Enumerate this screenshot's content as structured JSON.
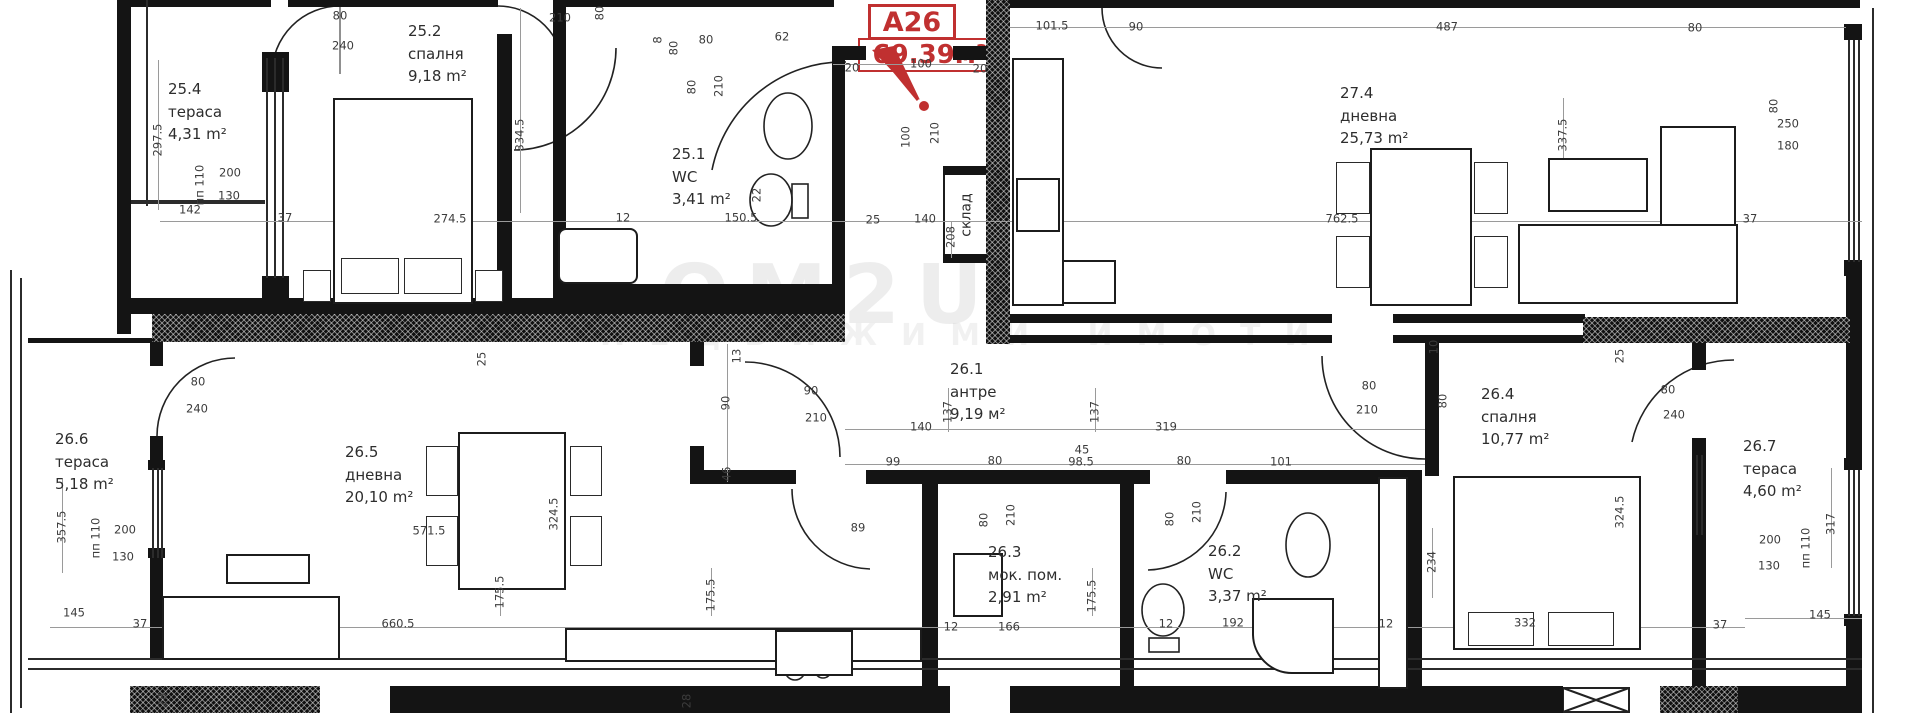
{
  "badge": {
    "unit": "A26",
    "area": "69.39м²"
  },
  "watermark": {
    "line1": "НОМ2U",
    "line2": "НЕДВИЖИМИ ИМОТИ"
  },
  "storage_label": "склад",
  "fridge_label": "F",
  "rooms": [
    {
      "num": "25.4",
      "name": "тераса",
      "area": "4,31 m²",
      "x": 168,
      "y": 78
    },
    {
      "num": "25.2",
      "name": "спалня",
      "area": "9,18 m²",
      "x": 408,
      "y": 20
    },
    {
      "num": "25.1",
      "name": "WC",
      "area": "3,41 m²",
      "x": 672,
      "y": 143
    },
    {
      "num": "27.4",
      "name": "дневна",
      "area": "25,73 m²",
      "x": 1340,
      "y": 82
    },
    {
      "num": "26.1",
      "name": "антре",
      "area": "9,19 м²",
      "x": 950,
      "y": 358
    },
    {
      "num": "26.6",
      "name": "тераса",
      "area": "5,18 m²",
      "x": 55,
      "y": 428
    },
    {
      "num": "26.5",
      "name": "дневна",
      "area": "20,10 m²",
      "x": 345,
      "y": 441
    },
    {
      "num": "26.3",
      "name": "мок. пом.",
      "area": "2,91 m²",
      "x": 988,
      "y": 541
    },
    {
      "num": "26.2",
      "name": "WC",
      "area": "3,37 m²",
      "x": 1208,
      "y": 540
    },
    {
      "num": "26.4",
      "name": "спалня",
      "area": "10,77 m²",
      "x": 1481,
      "y": 383
    },
    {
      "num": "26.7",
      "name": "тераса",
      "area": "4,60 m²",
      "x": 1743,
      "y": 435
    }
  ],
  "dims": [
    {
      "t": "80",
      "x": 340,
      "y": 16
    },
    {
      "t": "240",
      "x": 343,
      "y": 46
    },
    {
      "t": "210",
      "x": 560,
      "y": 18
    },
    {
      "t": "80",
      "x": 600,
      "y": 13,
      "v": 1
    },
    {
      "t": "8",
      "x": 658,
      "y": 40,
      "v": 1
    },
    {
      "t": "80",
      "x": 674,
      "y": 48,
      "v": 1
    },
    {
      "t": "80",
      "x": 706,
      "y": 40
    },
    {
      "t": "62",
      "x": 782,
      "y": 37
    },
    {
      "t": "80",
      "x": 692,
      "y": 87,
      "v": 1
    },
    {
      "t": "210",
      "x": 719,
      "y": 86,
      "v": 1
    },
    {
      "t": "20",
      "x": 852,
      "y": 68
    },
    {
      "t": "100",
      "x": 921,
      "y": 64
    },
    {
      "t": "20",
      "x": 980,
      "y": 69
    },
    {
      "t": "100",
      "x": 906,
      "y": 137,
      "v": 1
    },
    {
      "t": "210",
      "x": 935,
      "y": 133,
      "v": 1
    },
    {
      "t": "101.5",
      "x": 1052,
      "y": 26
    },
    {
      "t": "90",
      "x": 1136,
      "y": 27
    },
    {
      "t": "487",
      "x": 1447,
      "y": 27
    },
    {
      "t": "80",
      "x": 1695,
      "y": 28
    },
    {
      "t": "80",
      "x": 1774,
      "y": 106,
      "v": 1
    },
    {
      "t": "250",
      "x": 1788,
      "y": 124
    },
    {
      "t": "180",
      "x": 1788,
      "y": 146
    },
    {
      "t": "337.5",
      "x": 1563,
      "y": 135,
      "v": 1
    },
    {
      "t": "297.5",
      "x": 158,
      "y": 140,
      "v": 1
    },
    {
      "t": "пп 110",
      "x": 200,
      "y": 185,
      "v": 1
    },
    {
      "t": "200",
      "x": 230,
      "y": 173
    },
    {
      "t": "130",
      "x": 229,
      "y": 196
    },
    {
      "t": "142",
      "x": 190,
      "y": 210
    },
    {
      "t": "37",
      "x": 285,
      "y": 218
    },
    {
      "t": "274.5",
      "x": 450,
      "y": 219
    },
    {
      "t": "334.5",
      "x": 520,
      "y": 135,
      "v": 1
    },
    {
      "t": "12",
      "x": 623,
      "y": 218
    },
    {
      "t": "150.5",
      "x": 741,
      "y": 218
    },
    {
      "t": "22",
      "x": 757,
      "y": 195,
      "v": 1
    },
    {
      "t": "25",
      "x": 873,
      "y": 220
    },
    {
      "t": "140",
      "x": 925,
      "y": 219
    },
    {
      "t": "208",
      "x": 951,
      "y": 237,
      "v": 1
    },
    {
      "t": "762.5",
      "x": 1342,
      "y": 219
    },
    {
      "t": "37",
      "x": 1750,
      "y": 219
    },
    {
      "t": "80",
      "x": 198,
      "y": 382
    },
    {
      "t": "240",
      "x": 197,
      "y": 409
    },
    {
      "t": "13",
      "x": 737,
      "y": 356,
      "v": 1
    },
    {
      "t": "90",
      "x": 726,
      "y": 403,
      "v": 1
    },
    {
      "t": "90",
      "x": 811,
      "y": 391
    },
    {
      "t": "210",
      "x": 816,
      "y": 418
    },
    {
      "t": "46",
      "x": 727,
      "y": 474,
      "v": 1
    },
    {
      "t": "25",
      "x": 482,
      "y": 359,
      "v": 1
    },
    {
      "t": "140",
      "x": 921,
      "y": 427
    },
    {
      "t": "137",
      "x": 948,
      "y": 412,
      "v": 1
    },
    {
      "t": "137",
      "x": 1095,
      "y": 412,
      "v": 1
    },
    {
      "t": "99",
      "x": 893,
      "y": 462
    },
    {
      "t": "80",
      "x": 995,
      "y": 461
    },
    {
      "t": "45",
      "x": 1082,
      "y": 450
    },
    {
      "t": "98.5",
      "x": 1081,
      "y": 462
    },
    {
      "t": "319",
      "x": 1166,
      "y": 427
    },
    {
      "t": "80",
      "x": 1184,
      "y": 461
    },
    {
      "t": "101",
      "x": 1281,
      "y": 462
    },
    {
      "t": "80",
      "x": 984,
      "y": 520,
      "v": 1
    },
    {
      "t": "210",
      "x": 1011,
      "y": 515,
      "v": 1
    },
    {
      "t": "80",
      "x": 1170,
      "y": 519,
      "v": 1
    },
    {
      "t": "210",
      "x": 1197,
      "y": 512,
      "v": 1
    },
    {
      "t": "80",
      "x": 1369,
      "y": 386
    },
    {
      "t": "210",
      "x": 1367,
      "y": 410
    },
    {
      "t": "10",
      "x": 1434,
      "y": 347,
      "v": 1
    },
    {
      "t": "80",
      "x": 1443,
      "y": 401,
      "v": 1
    },
    {
      "t": "25",
      "x": 1620,
      "y": 356,
      "v": 1
    },
    {
      "t": "80",
      "x": 1668,
      "y": 390
    },
    {
      "t": "240",
      "x": 1674,
      "y": 415
    },
    {
      "t": "324.5",
      "x": 554,
      "y": 514,
      "v": 1
    },
    {
      "t": "324.5",
      "x": 1620,
      "y": 512,
      "v": 1
    },
    {
      "t": "571.5",
      "x": 429,
      "y": 531
    },
    {
      "t": "89",
      "x": 858,
      "y": 528
    },
    {
      "t": "175.5",
      "x": 500,
      "y": 592,
      "v": 1
    },
    {
      "t": "175.5",
      "x": 711,
      "y": 595,
      "v": 1
    },
    {
      "t": "175.5",
      "x": 1092,
      "y": 596,
      "v": 1
    },
    {
      "t": "234",
      "x": 1432,
      "y": 562,
      "v": 1
    },
    {
      "t": "332",
      "x": 1525,
      "y": 623
    },
    {
      "t": "37",
      "x": 1720,
      "y": 625
    },
    {
      "t": "12",
      "x": 1166,
      "y": 624
    },
    {
      "t": "192",
      "x": 1233,
      "y": 623
    },
    {
      "t": "12",
      "x": 1386,
      "y": 624
    },
    {
      "t": "12",
      "x": 951,
      "y": 627
    },
    {
      "t": "166",
      "x": 1009,
      "y": 627
    },
    {
      "t": "660.5",
      "x": 398,
      "y": 624
    },
    {
      "t": "145",
      "x": 74,
      "y": 613
    },
    {
      "t": "37",
      "x": 140,
      "y": 624
    },
    {
      "t": "357.5",
      "x": 62,
      "y": 527,
      "v": 1
    },
    {
      "t": "пп 110",
      "x": 96,
      "y": 538,
      "v": 1
    },
    {
      "t": "200",
      "x": 125,
      "y": 530
    },
    {
      "t": "130",
      "x": 123,
      "y": 557
    },
    {
      "t": "317",
      "x": 1831,
      "y": 524,
      "v": 1
    },
    {
      "t": "пп 110",
      "x": 1806,
      "y": 548,
      "v": 1
    },
    {
      "t": "200",
      "x": 1770,
      "y": 540
    },
    {
      "t": "130",
      "x": 1769,
      "y": 566
    },
    {
      "t": "145",
      "x": 1820,
      "y": 615
    },
    {
      "t": "28",
      "x": 163,
      "y": 700,
      "v": 1
    },
    {
      "t": "28",
      "x": 687,
      "y": 701,
      "v": 1
    }
  ]
}
